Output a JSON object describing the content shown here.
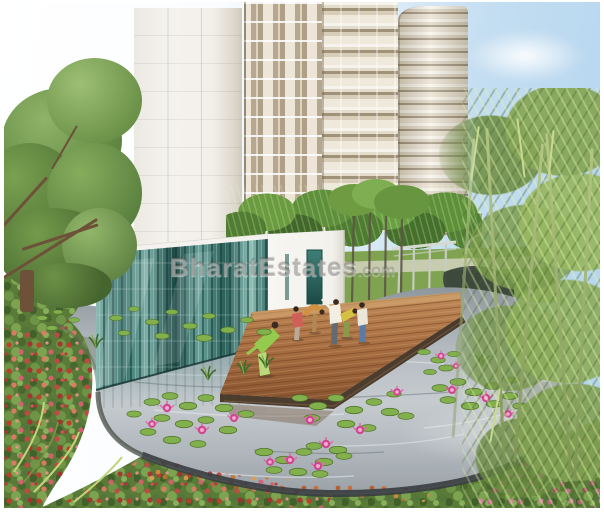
{
  "watermark": {
    "text": "BharatEstates",
    "suffix": ".com"
  },
  "scene": {
    "label": "residential-complex-lotus-pond-rendering",
    "elements": [
      "sky",
      "clouds",
      "residential-towers",
      "left-tree",
      "palm-hedge",
      "clubhouse-glass-facade",
      "clubhouse-white-wall",
      "clubhouse-door",
      "pergola",
      "bamboo-grove",
      "lotus-pond",
      "pond-rim",
      "wooden-deck",
      "people-exercising",
      "water-lilies",
      "lotus-flowers",
      "flower-beds",
      "lawn"
    ]
  },
  "palette": {
    "sky_blue": "#b3d5ee",
    "tower_cream": "#e9e2d4",
    "glass_teal": "#2e6b64",
    "water_gray": "#b4bbc0",
    "deck_wood": "#a96f42",
    "tree_green": "#6b9148",
    "bamboo_green": "#a9c573",
    "flower_red": "#c33a2c",
    "lotus_pink": "#d64f9d",
    "background_white": "#ffffff"
  }
}
